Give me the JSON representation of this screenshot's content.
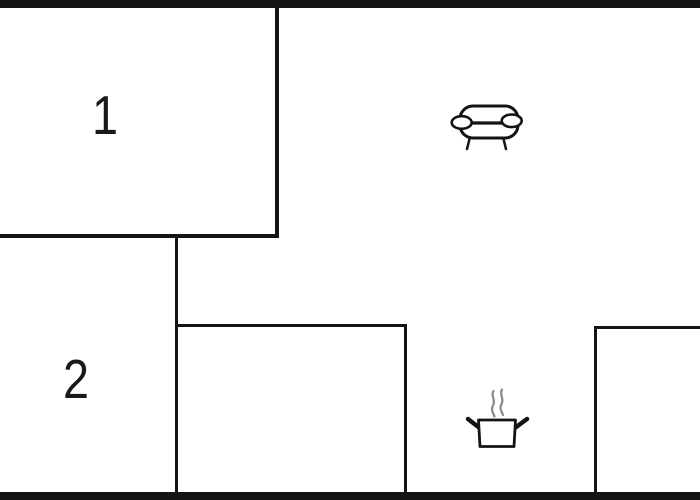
{
  "floorplan": {
    "rooms": [
      {
        "id": "room-1",
        "label": "1"
      },
      {
        "id": "room-2",
        "label": "2"
      }
    ],
    "icons": [
      {
        "name": "sofa-icon"
      },
      {
        "name": "cooking-pot-icon"
      }
    ],
    "colors": {
      "background": "#ffffff",
      "wall": "#141414",
      "label": "#1a1a1a",
      "steam": "#8a8a8a"
    }
  }
}
